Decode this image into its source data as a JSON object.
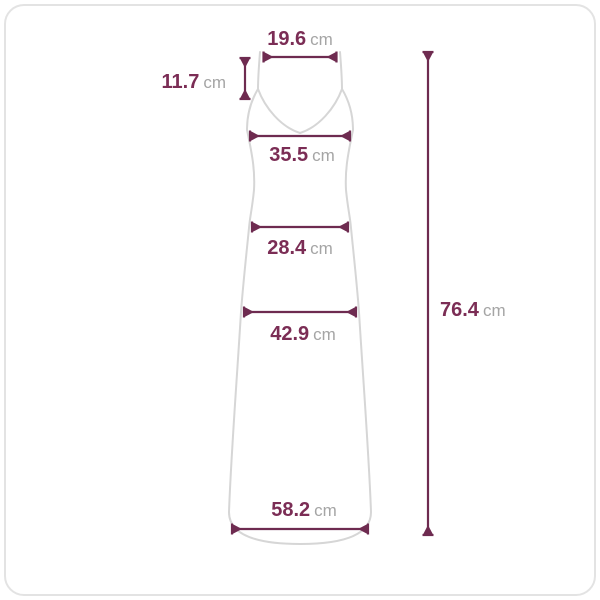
{
  "diagram": {
    "colors": {
      "measure_line": "#6e2b50",
      "value_text": "#7b2d55",
      "unit_text": "#a5a5a5",
      "garment_outline": "#d6d6d6",
      "frame_border": "#e3e3e3",
      "background": "#ffffff"
    },
    "measurements": {
      "top_width": {
        "value": "19.6",
        "unit": "cm"
      },
      "strap_length": {
        "value": "11.7",
        "unit": "cm"
      },
      "bust_width": {
        "value": "35.5",
        "unit": "cm"
      },
      "waist_width": {
        "value": "28.4",
        "unit": "cm"
      },
      "hip_width": {
        "value": "42.9",
        "unit": "cm"
      },
      "hem_width": {
        "value": "58.2",
        "unit": "cm"
      },
      "total_length": {
        "value": "76.4",
        "unit": "cm"
      }
    }
  }
}
